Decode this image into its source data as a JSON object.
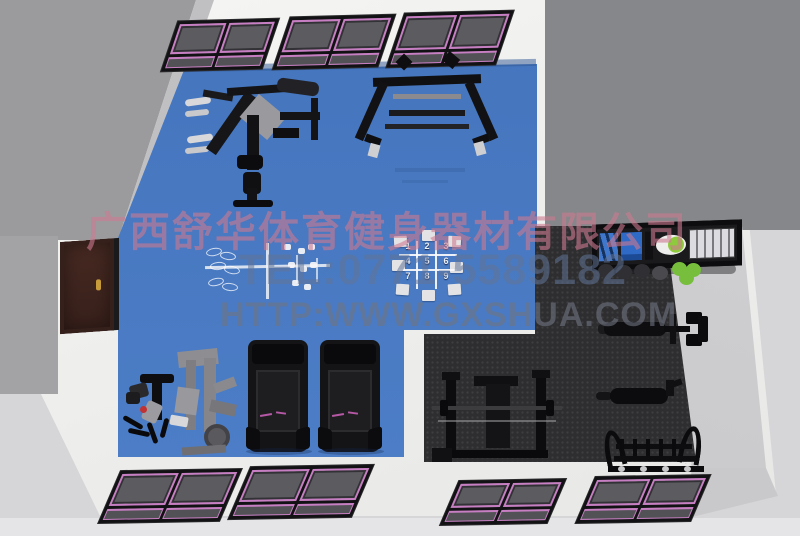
{
  "watermark": {
    "company": "广西舒华体育健身器材有限公司",
    "phone": "TEL:0771-5589182",
    "website": "HTTP:WWW.GXSHUA.COM"
  },
  "game_grid": {
    "cells": [
      "1",
      "2",
      "3",
      "4",
      "5",
      "6",
      "7",
      "8",
      "9"
    ]
  },
  "colors": {
    "floor_blue": "#4a7ac2",
    "floor_rubber": "#2e2e30",
    "floor_light": "#cdcdcf",
    "window_accent_magenta": "#c77ec2",
    "door_brown": "#42261f",
    "ball_green": "#76be3c",
    "watermark_pink": "rgba(205,122,144,0.60)",
    "watermark_blue": "rgba(98,117,152,0.55)",
    "watermark_grey": "rgba(112,117,128,0.60)"
  }
}
